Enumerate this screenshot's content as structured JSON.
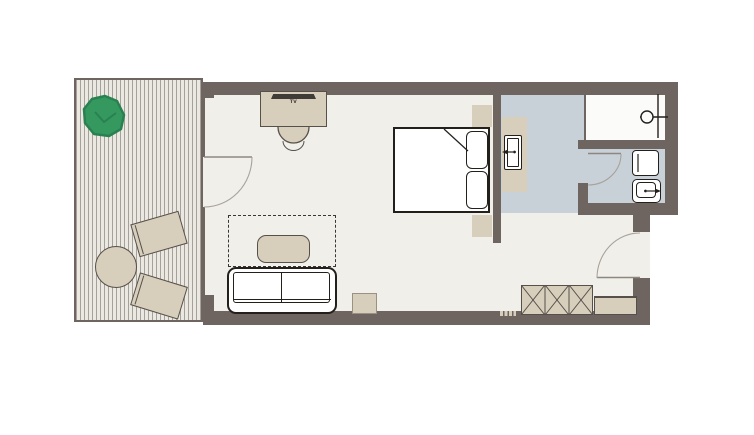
{
  "title": "Hotel room floor plan",
  "labels": {
    "tv": "TV"
  },
  "colors": {
    "canvas": "#ffffff",
    "wall": "#6e6561",
    "floor": "#f1efe9",
    "deck": "#ebe8e2",
    "deck-stripe": "#a6a09a",
    "bath-floor": "#c8d1d7",
    "shower-floor": "#fbfbfa",
    "furniture": "#d7cebc",
    "furniture-edge": "#55504a",
    "fixture": "#ffffff",
    "ink": "#23201c",
    "door-arc": "#a8a29c",
    "door-leaf": "#8d8782",
    "plant": "#35995f",
    "plant-edge": "#2a8150",
    "tv-bar": "#3f3b37"
  },
  "items": [
    "terrace-deck",
    "plant",
    "terrace-round-table",
    "lounge-chair",
    "lounge-chair",
    "desk",
    "tv",
    "desk-chair",
    "double-bed",
    "pillow",
    "pillow",
    "nightstand",
    "nightstand",
    "rug",
    "coffee-table",
    "sofa",
    "side-table",
    "vanity-counter",
    "vanity-sink",
    "faucet-icon",
    "shower",
    "shower-head",
    "glass-screen",
    "wc-washbasin",
    "wc-toilet",
    "flush-icon",
    "terrace-door",
    "wc-door",
    "entry-door",
    "wardrobe",
    "luggage-bench",
    "floor-vent"
  ]
}
